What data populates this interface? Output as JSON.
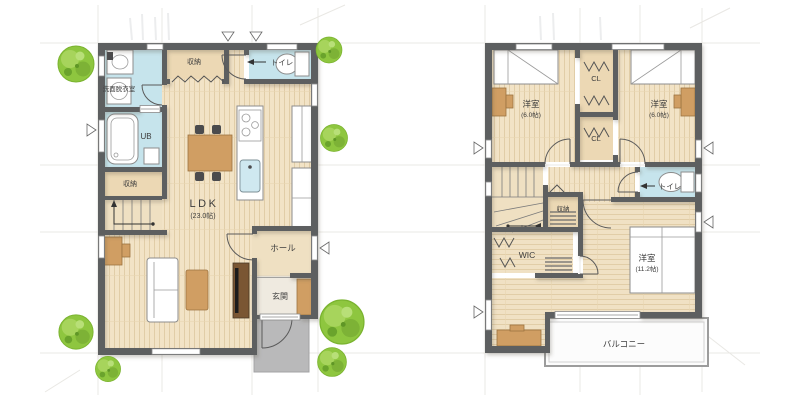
{
  "colors": {
    "wall": "#5d5f61",
    "floor_wood": "#f2e3c6",
    "floor_stripe": "#e1cda7",
    "floor_plain": "#efe0c2",
    "closet": "#ecd8b4",
    "wet_room": "#c6e4ec",
    "furniture_wood": "#d09e63",
    "fixture_white": "#ffffff",
    "tree_green": "#8ec63f",
    "tree_green_dark": "#74ab31",
    "tree_green_light": "#a9d55e",
    "porch_gray": "#b9b9ba",
    "balcony_white": "#fcfcfc",
    "text": "#3c3c3c"
  },
  "first_floor": {
    "rooms": {
      "washroom": {
        "label": "洗面脱衣室"
      },
      "storage_top": {
        "label": "収納"
      },
      "toilet": {
        "label": "トイレ"
      },
      "bath": {
        "label": "UB"
      },
      "storage_mid": {
        "label": "収納"
      },
      "ldk": {
        "label": "LDK",
        "size": "(23.0帖)"
      },
      "hall": {
        "label": "ホール"
      },
      "entrance": {
        "label": "玄関"
      }
    }
  },
  "second_floor": {
    "rooms": {
      "bedroom_left": {
        "label": "洋室",
        "size": "(6.0帖)"
      },
      "bedroom_right": {
        "label": "洋室",
        "size": "(6.0帖)"
      },
      "closet_upper": {
        "label": "CL"
      },
      "closet_lower": {
        "label": "CL"
      },
      "storage": {
        "label": "収納"
      },
      "toilet": {
        "label": "トイレ"
      },
      "wic": {
        "label": "WIC"
      },
      "bedroom_main": {
        "label": "洋室",
        "size": "(11.2帖)"
      },
      "balcony": {
        "label": "バルコニー"
      }
    }
  }
}
